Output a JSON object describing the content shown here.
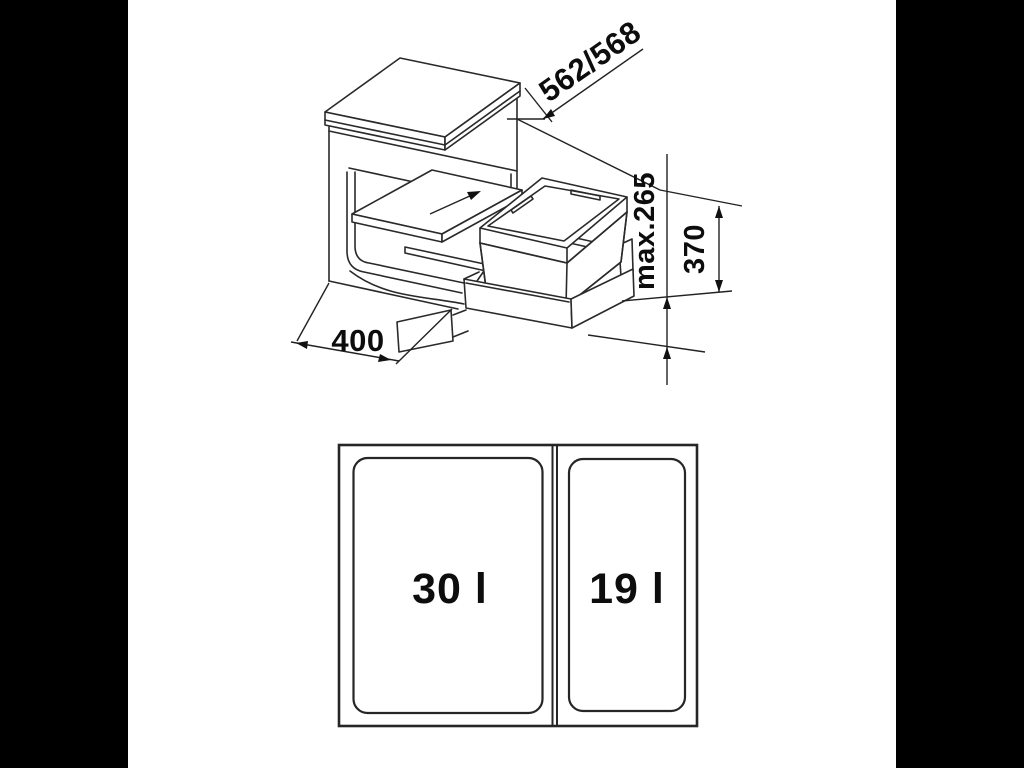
{
  "iso": {
    "dim_depth": {
      "label": "562/568"
    },
    "dim_max_height": {
      "label": "max.265"
    },
    "dim_unit_height": {
      "label": "370"
    },
    "dim_width": {
      "label": "400"
    },
    "slide_arrow_icon": "direction-arrow"
  },
  "top_view": {
    "bin_left": {
      "label": "30 l"
    },
    "bin_right": {
      "label": "19 l"
    }
  },
  "colors": {
    "line": "#2a2a2a",
    "background": "#ffffff",
    "matte": "#000000"
  }
}
